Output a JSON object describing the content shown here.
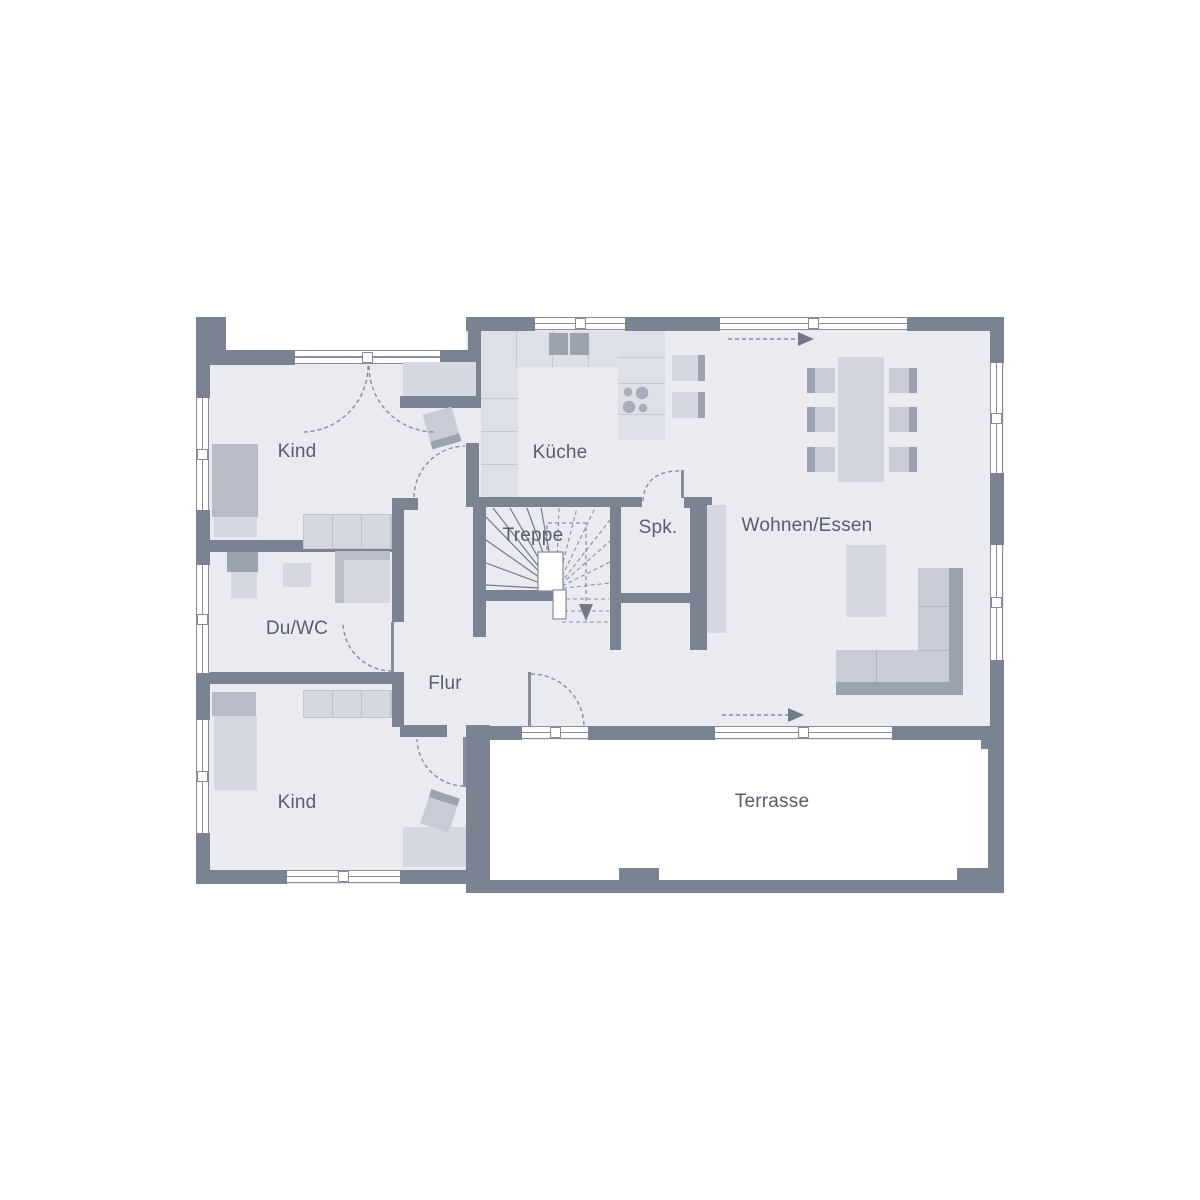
{
  "plan": {
    "rooms": [
      {
        "id": "kind-1",
        "label": "Kind"
      },
      {
        "id": "kueche",
        "label": "Küche"
      },
      {
        "id": "treppe",
        "label": "Treppe"
      },
      {
        "id": "spk",
        "label": "Spk."
      },
      {
        "id": "wohnen-essen",
        "label": "Wohnen/Essen"
      },
      {
        "id": "du-wc",
        "label": "Du/WC"
      },
      {
        "id": "flur",
        "label": "Flur"
      },
      {
        "id": "kind-2",
        "label": "Kind"
      },
      {
        "id": "terrasse",
        "label": "Terrasse"
      }
    ],
    "icons": [
      "stair-down-arrow",
      "sliding-door-arrow-top",
      "sliding-door-arrow-bottom",
      "door-swing-arcs",
      "stove-burners",
      "kitchen-sink"
    ],
    "colors": {
      "wall": "#7b8393",
      "floor": "#e9ebf1",
      "furniture_light": "#d5d8e0",
      "furniture_mid": "#c8ccd6",
      "furniture_dark": "#9ba2b0",
      "line": "#868d9c",
      "text": "#565e6d",
      "terrace": "#ffffff"
    }
  }
}
